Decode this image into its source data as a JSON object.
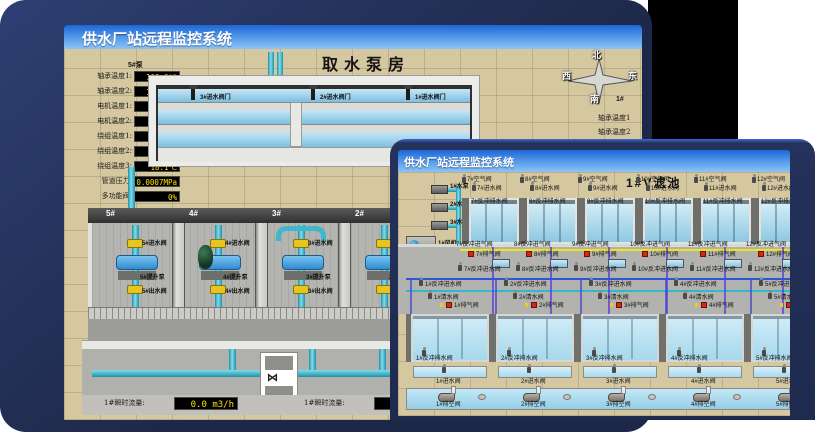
{
  "colors": {
    "frame_navy": "#233158",
    "titlebar_blue": "#1d66d6",
    "value_yellow": "#ffe400",
    "alarm_red": "#d42814",
    "pipe_teal": "#3fb6cc",
    "valve_yellow": "#e8c51e"
  },
  "back": {
    "title": "供水厂站远程监控系统",
    "scene_title": "取水泵房",
    "panel": {
      "header": "5#泵",
      "rows": [
        {
          "label": "轴承温度1:",
          "value": "100.0℃"
        },
        {
          "label": "轴承温度2:",
          "value": "100.0℃"
        },
        {
          "label": "电机温度1:",
          "value": "18.1℃"
        },
        {
          "label": "电机温度2:",
          "value": "17.9℃"
        },
        {
          "label": "绕组温度1:",
          "value": "18.0℃"
        },
        {
          "label": "绕组温度2:",
          "value": "18.1℃"
        },
        {
          "label": "绕组温度3:",
          "value": "18.1℃"
        },
        {
          "label": "管道压力:",
          "value": "0.0007MPa"
        },
        {
          "label": "多功能阀:",
          "value": "0%"
        }
      ]
    },
    "inlet_valves": [
      "3#进水阀门",
      "2#进水阀门",
      "1#进水阀门"
    ],
    "compass": {
      "north": "北",
      "south": "南",
      "west": "西",
      "east": "东"
    },
    "right_panel": {
      "header": "1#",
      "rows": [
        "轴承温度1",
        "轴承温度2"
      ]
    },
    "bays": [
      {
        "name": "5#",
        "inlet": "5#进水阀",
        "pump": "5#提升泵",
        "outlet": "5#出水阀"
      },
      {
        "name": "4#",
        "inlet": "4#进水阀",
        "pump": "4#提升泵",
        "outlet": "4#出水阀"
      },
      {
        "name": "3#",
        "inlet": "3#进水阀",
        "pump": "3#提升泵",
        "outlet": "3#出水阀"
      },
      {
        "name": "2#",
        "inlet": "2#进水阀",
        "pump": "2#提升泵",
        "outlet": "2#出水阀"
      }
    ],
    "readouts": {
      "current_mid_label": "4#泵电流:",
      "current_mid_value": "00.0 A",
      "current_right_label": "2#泵电流:",
      "flow_left_label": "1#瞬时流量:",
      "flow_left_value": "0.0 m3/h",
      "flow_right_label": "1#瞬时流量:",
      "flow_right_value": "0.0 m3/"
    }
  },
  "front": {
    "title": "供水厂站远程监控系统",
    "scene_title": "1#V滤池",
    "equipment": [
      "1#水泵",
      "2#水泵",
      "3#水泵",
      "1#风机",
      "2#风机",
      "3#风机"
    ],
    "top": {
      "air": [
        "7#空气阀",
        "8#空气阀",
        "9#空气阀",
        "10#空气阀",
        "11#空气阀",
        "12#空气阀"
      ],
      "inlet": [
        "7#进水阀",
        "8#进水阀",
        "9#进水阀",
        "10#进水阀",
        "11#进水阀",
        "12#进水阀"
      ],
      "drain": [
        "7#反冲排水阀",
        "8#反冲排水阀",
        "9#反冲排水阀",
        "10#反冲排水阀",
        "11#反冲排水阀",
        "12#反冲排水阀"
      ],
      "air_inlet": [
        "7#反冲进气阀",
        "8#反冲进气阀",
        "9#反冲进气阀",
        "10#反冲进气阀",
        "11#反冲进气阀",
        "12#反冲进气阀"
      ],
      "exhaust": [
        "7#排气阀",
        "8#排气阀",
        "9#排气阀",
        "10#排气阀",
        "11#排气阀",
        "12#排气阀"
      ],
      "backwash": [
        "7#反冲进水阀",
        "8#反冲进水阀",
        "9#反冲进水阀",
        "10#反冲进水阀",
        "11#反冲进水阀",
        "12#反冲进水阀"
      ]
    },
    "bottom": {
      "backwash": [
        "1#反冲进水阀",
        "2#反冲进水阀",
        "3#反冲进水阀",
        "4#反冲进水阀",
        "5#反冲进水阀"
      ],
      "clean": [
        "1#清水阀",
        "2#清水阀",
        "3#清水阀",
        "4#清水阀",
        "5#清水阀"
      ],
      "exhaust": [
        "1#排气阀",
        "2#排气阀",
        "3#排气阀",
        "4#排气阀",
        "5#排气阀"
      ],
      "drain": [
        "1#反冲排水阀",
        "2#反冲排水阀",
        "3#反冲排水阀",
        "4#反冲排水阀",
        "5#反冲排水阀"
      ],
      "inlet": [
        "1#进水阀",
        "2#进水阀",
        "3#进水阀",
        "4#进水阀",
        "5#进水阀"
      ],
      "empty": [
        "1#排空阀",
        "2#排空阀",
        "3#排空阀",
        "4#排空阀",
        "5#排空阀"
      ]
    }
  }
}
